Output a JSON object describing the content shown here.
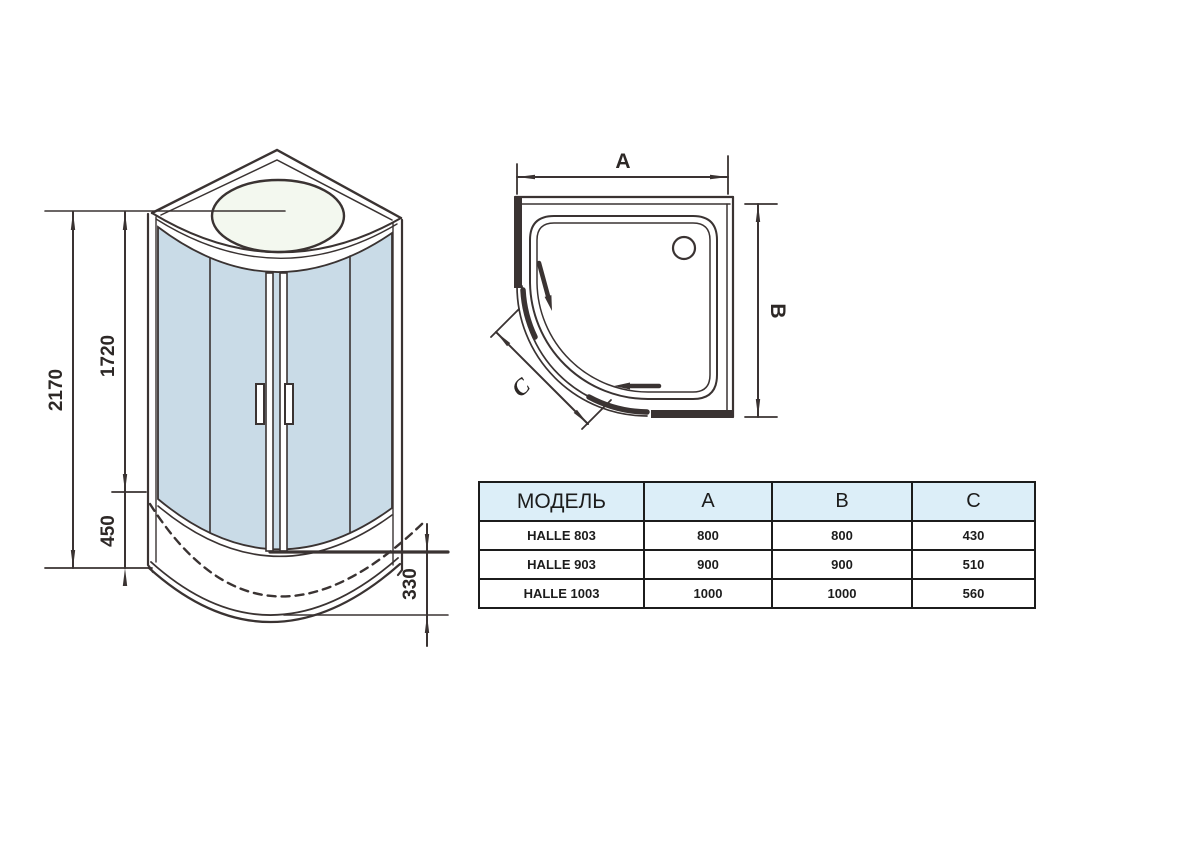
{
  "drawing": {
    "front_view": {
      "dim_total_height": "2170",
      "dim_glass_height": "1720",
      "dim_tray_height": "450",
      "dim_tray_depth": "330"
    },
    "top_view": {
      "dim_width_label": "A",
      "dim_depth_label": "B",
      "dim_front_label": "C"
    },
    "colors": {
      "line": "#3a3332",
      "glass": "#c9dbe7",
      "skylight": "#f3f8ef",
      "table_header_bg": "#dceef8"
    }
  },
  "table": {
    "columns": [
      "МОДЕЛЬ",
      "A",
      "B",
      "C"
    ],
    "rows": [
      {
        "model": "HALLE 803",
        "a": "800",
        "b": "800",
        "c": "430"
      },
      {
        "model": "HALLE 903",
        "a": "900",
        "b": "900",
        "c": "510"
      },
      {
        "model": "HALLE 1003",
        "a": "1000",
        "b": "1000",
        "c": "560"
      }
    ]
  }
}
